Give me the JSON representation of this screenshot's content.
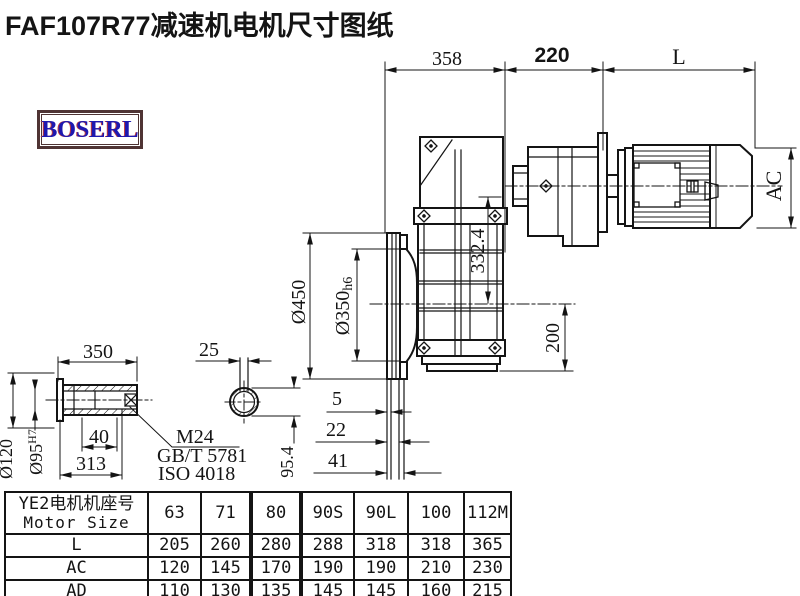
{
  "title": "FAF107R77减速机电机尺寸图纸",
  "logo": "BOSERL",
  "colors": {
    "ink": "#141414",
    "logo_border": "#4f3434",
    "logo_text": "#1e18b0",
    "logo_shadow": "#c43a3a"
  },
  "dims": {
    "depth_total": "358",
    "adapter_len": "220",
    "motor_len": "L",
    "motor_diameter": "AC",
    "height_to_axis": "332.4",
    "flange_od": "Ø450",
    "spigot_main": "Ø350",
    "spigot_tol": "h6",
    "axis_height": "200",
    "face_offset_1": "5",
    "face_offset_2": "22",
    "face_offset_3": "41",
    "shaft_length": "350",
    "key_width": "25",
    "thread_depth": "40",
    "shaft_inner_len": "313",
    "shaft_od": "Ø120",
    "bore_main": "Ø95",
    "bore_tol": "H7",
    "thread": "M24",
    "standard_gb": "GB/T 5781",
    "standard_iso": "ISO 4018",
    "across_key": "95.4"
  },
  "table": {
    "header_cn": "YE2电机机座号",
    "header_en": "Motor Size",
    "columns": [
      "63",
      "71",
      "80",
      "90S",
      "90L",
      "100",
      "112M"
    ],
    "rows": [
      {
        "label": "L",
        "values": [
          "205",
          "260",
          "280",
          "288",
          "318",
          "318",
          "365"
        ]
      },
      {
        "label": "AC",
        "values": [
          "120",
          "145",
          "170",
          "190",
          "190",
          "210",
          "230"
        ]
      },
      {
        "label": "AD",
        "values": [
          "110",
          "130",
          "135",
          "145",
          "145",
          "160",
          "215"
        ]
      }
    ]
  }
}
